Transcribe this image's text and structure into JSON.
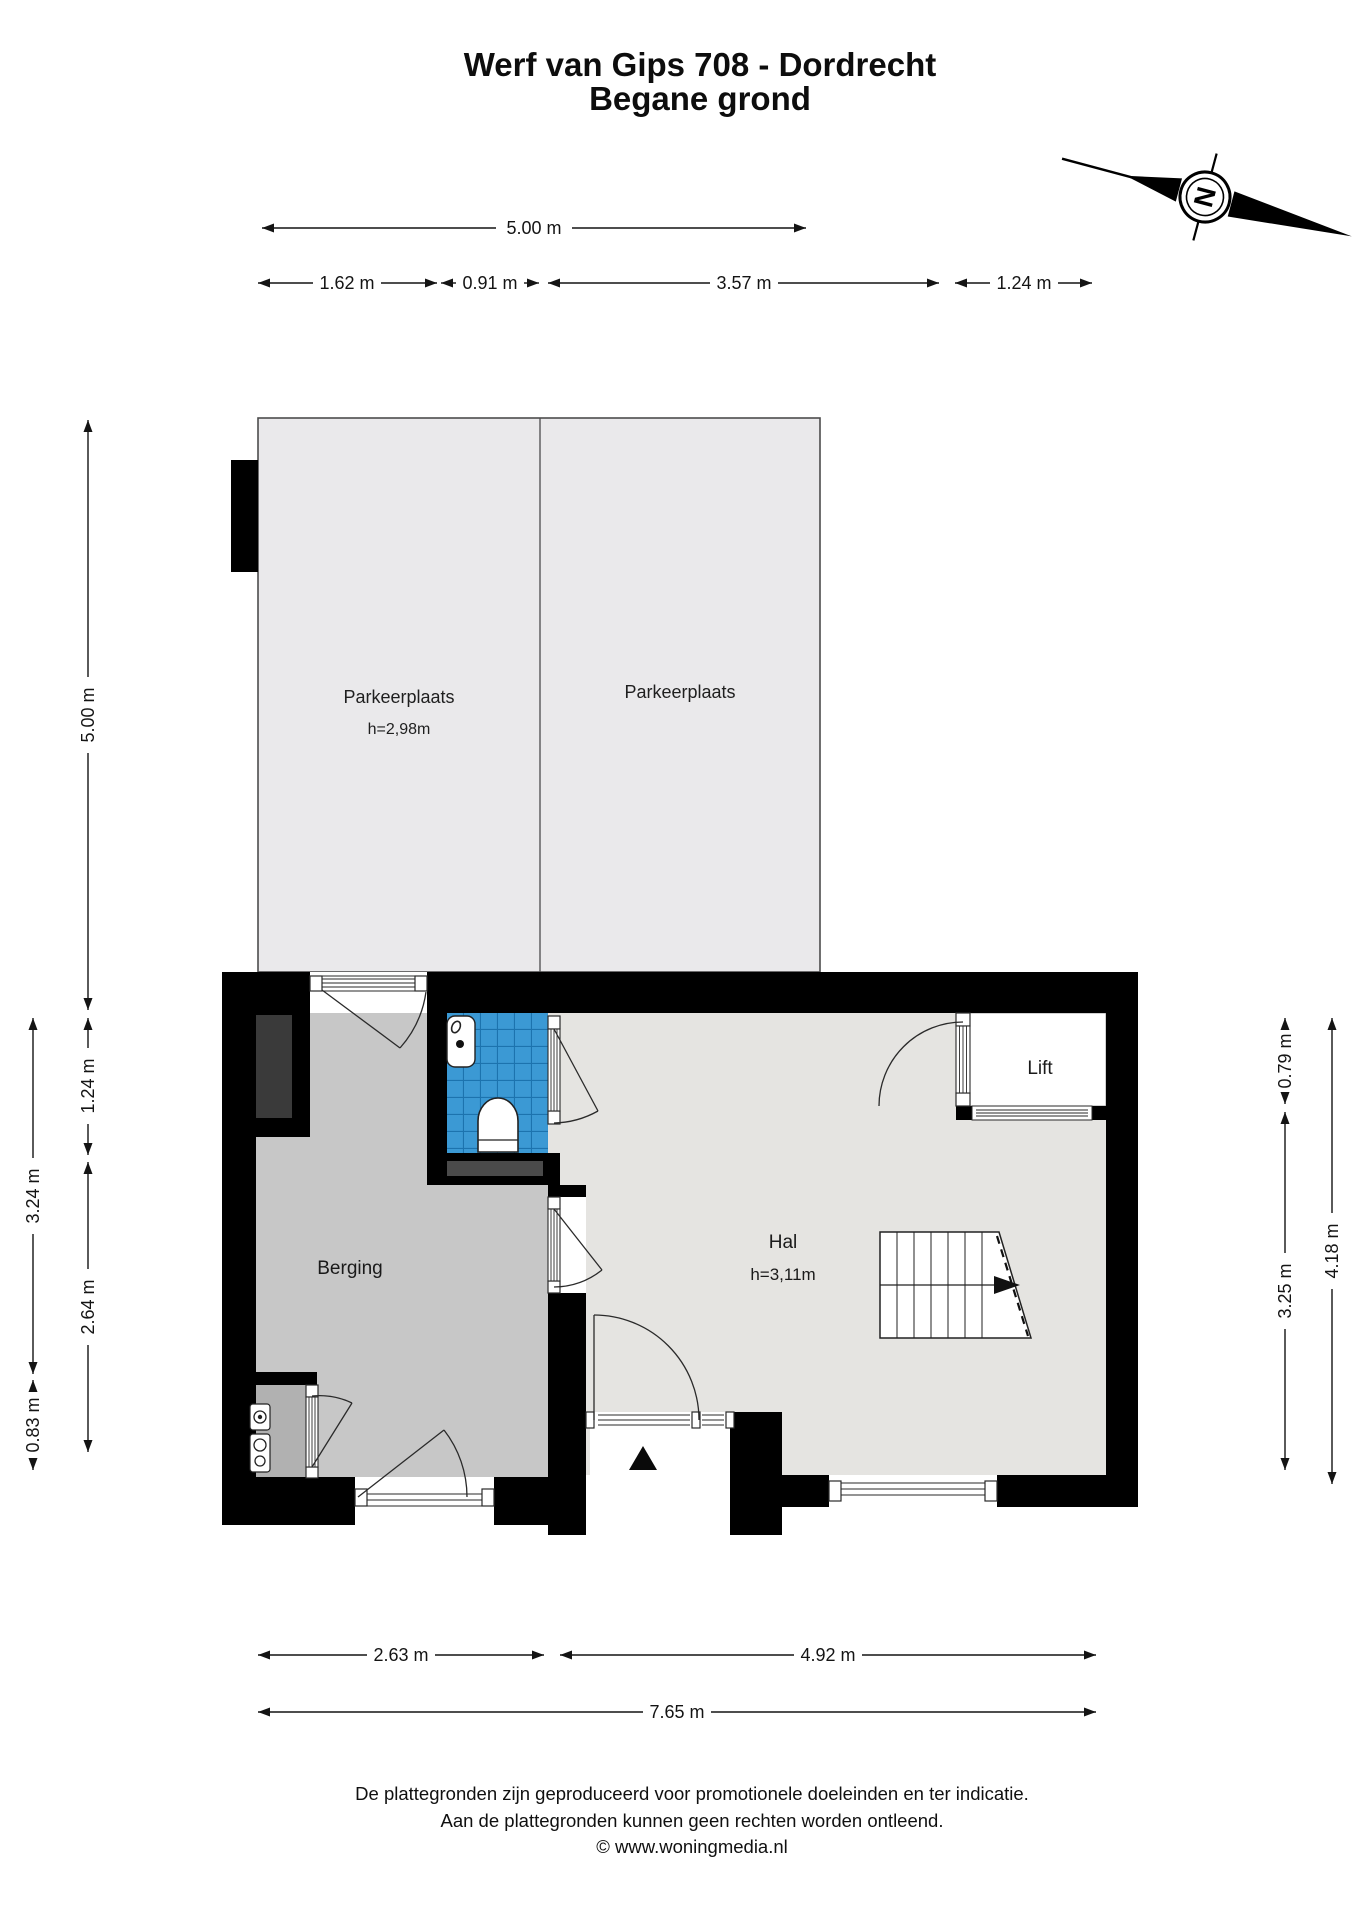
{
  "title": {
    "line1": "Werf van Gips 708 - Dordrecht",
    "line2": "Begane grond"
  },
  "compass": {
    "north_label": "N"
  },
  "parking": {
    "left": {
      "name": "Parkeerplaats",
      "ceiling_height": "h=2,98m"
    },
    "right": {
      "name": "Parkeerplaats"
    }
  },
  "rooms": {
    "berging": {
      "name": "Berging"
    },
    "hal": {
      "name": "Hal",
      "ceiling_height": "h=3,11m"
    },
    "lift": {
      "name": "Lift"
    }
  },
  "dimensions": {
    "top_total": "5.00 m",
    "top_row2": [
      "1.62 m",
      "0.91 m",
      "3.57 m",
      "1.24 m"
    ],
    "left_inner": [
      "5.00 m",
      "1.24 m",
      "2.64 m"
    ],
    "left_outer": [
      "3.24 m",
      "0.83 m"
    ],
    "right_inner": [
      "0.79 m",
      "3.25 m"
    ],
    "right_outer": "4.18 m",
    "bottom_row": [
      "2.63 m",
      "4.92 m"
    ],
    "bottom_total": "7.65 m"
  },
  "footer": {
    "line1": "De plattegronden zijn geproduceerd voor promotionele doeleinden en ter indicatie.",
    "line2": "Aan de plattegronden kunnen geen rechten worden ontleend.",
    "line3": "© www.woningmedia.nl"
  },
  "colors": {
    "walls": "#000000",
    "parking_fill": "#eae9eb",
    "berging_fill": "#c7c7c7",
    "nook_fill": "#b1b1b1",
    "hal_fill": "#e5e4e1",
    "lift_fill": "#ffffff",
    "toilet_tile_blue": "#3b99d4",
    "toilet_grout_blue": "#1c73ae",
    "cabinet_dark": "#3a3a3a"
  }
}
